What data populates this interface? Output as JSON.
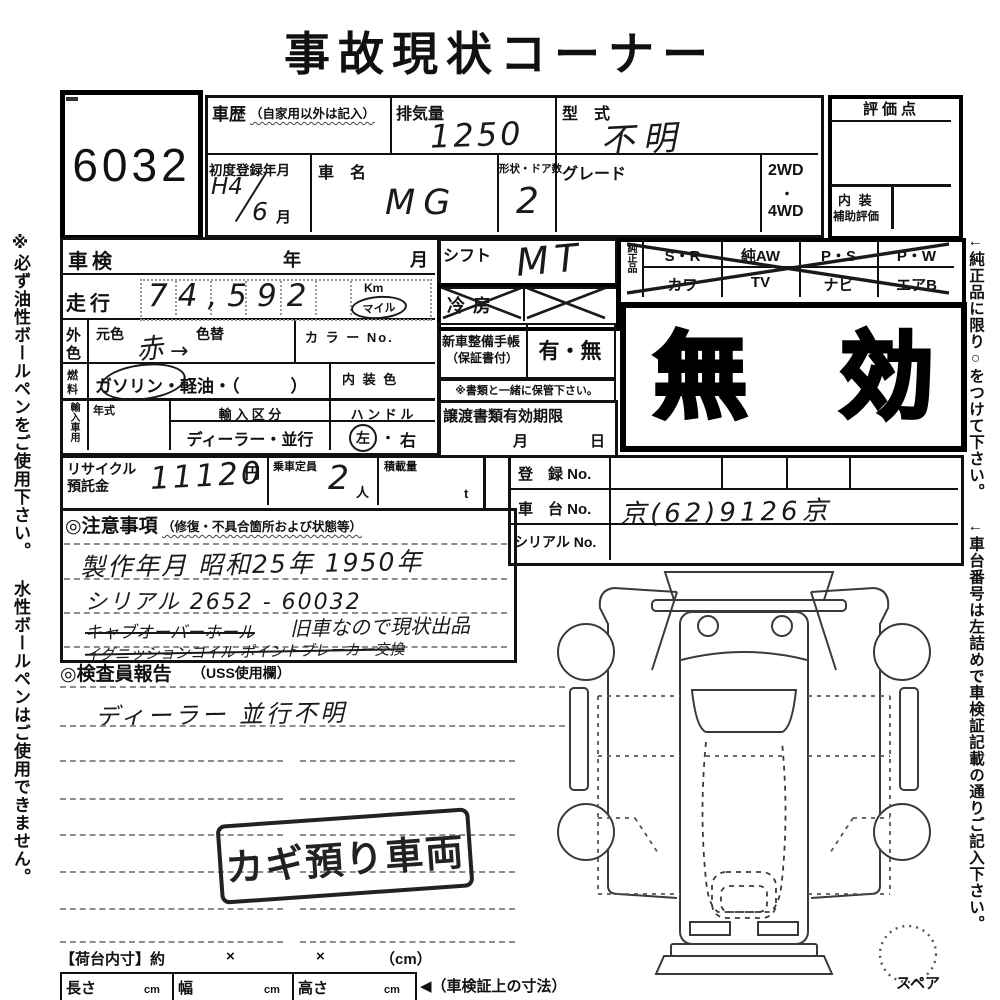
{
  "title": "事故現状コーナー",
  "lot_number": "6032",
  "header": {
    "history_label": "車歴",
    "history_note": "（自家用以外は記入）",
    "displacement_label": "排気量",
    "displacement_value": "1250",
    "model_label": "型　式",
    "model_value": "不明",
    "first_reg_label": "初度登録年月",
    "first_reg_era": "H4",
    "first_reg_month_value": "6",
    "first_reg_month_unit": "月",
    "car_name_label": "車　名",
    "car_name_value": "MG",
    "shape_doors_label": "形状・ドア数",
    "shape_doors_value": "2",
    "grade_label": "グレード",
    "wd2": "2WD",
    "wd_dot": "・",
    "wd4": "4WD",
    "score_label": "評価点",
    "interior_label": "内 装",
    "interior_sub_label": "補助評価"
  },
  "inspection": {
    "shaken_label": "車検",
    "year": "年",
    "month": "月",
    "mileage_label": "走行",
    "mileage_value": "74,592",
    "km": "Km",
    "mile": "マイル",
    "ext_color_1": "外",
    "ext_color_2": "色",
    "orig_color_label": "元色",
    "recolor_label": "色替",
    "color_value": "赤",
    "color_arrow": "→",
    "color_no_label": "カ ラ ー No.",
    "fuel_1": "燃",
    "fuel_2": "料",
    "fuel_pre": "ガ",
    "fuel_circled": "ソリン",
    "fuel_post": "・軽油・（　　　）",
    "int_color_label": "内 装 色",
    "import_label": "輸入車用",
    "year_model_label": "年式",
    "import_class_label": "輸 入 区 分",
    "import_class_value": "ディーラー・並行",
    "handle_label": "ハ ン ド ル",
    "handle_left": "左",
    "handle_dot": "・",
    "handle_right": "右"
  },
  "recycle": {
    "label_1": "リサイクル",
    "label_2": "預託金",
    "value": "11120",
    "yen": "円",
    "capacity_label": "乗車定員",
    "capacity_value": "2",
    "nin": "人",
    "load_label": "積載量",
    "ton": "t"
  },
  "shift": {
    "label": "シフト",
    "value": "MT",
    "ac_label": "冷房",
    "booklet_label_1": "新車整備手帳",
    "booklet_label_2": "（保証書付）",
    "booklet_value": "有・無",
    "keep_note": "※書類と一緒に保管下さい。",
    "transfer_label": "譲渡書類有効期限",
    "transfer_month": "月",
    "transfer_day": "日"
  },
  "genuine": {
    "label": "純正品",
    "row1": [
      "S・R",
      "純AW",
      "P・S",
      "P・W"
    ],
    "row2": [
      "カワ",
      "TV",
      "ナビ",
      "エアB"
    ]
  },
  "invalid_stamp": {
    "char1": "無",
    "char2": "効"
  },
  "registration": {
    "reg_no_label": "登　録 No.",
    "chassis_no_label": "車　台 No.",
    "chassis_no_value": "京(62)9126京",
    "serial_no_label": "シリアル No."
  },
  "notes": {
    "heading": "◎注意事項",
    "heading_note": "（修復・不具合箇所および状態等）",
    "line1": "製作年月 昭和25年 1950年",
    "line2": "シリアル 2652 - 60032",
    "line3_struck": "キャブオーバーホール",
    "line3_rest": "旧車なので現状出品",
    "line4_struck": "イグニッションコイル ポイントブレーカー交換"
  },
  "inspector": {
    "heading": "◎検査員報告",
    "heading_note": "（USS使用欄）",
    "value": "ディーラー 並行不明"
  },
  "key_stamp": "カギ預り車両",
  "diagram": {
    "spare_label": "スペア"
  },
  "cargo": {
    "label": "【荷台内寸】約",
    "x1": "×",
    "x2": "×",
    "cm_note": "（cm）",
    "length_label": "長さ",
    "cm1": "cm",
    "width_label": "幅",
    "cm2": "cm",
    "height_label": "高さ",
    "cm3": "cm",
    "arrow_note": "◀（車検証上の寸法）"
  },
  "sidebar": {
    "left": "※必ず油性ボールペンをご使用下さい。 水性ボールペンはご使用できません。",
    "right": "←純正品に限り○をつけて下さい。 ←車台番号は左詰めで車検証記載の通りご記入下さい。"
  },
  "colors": {
    "ink": "#111111",
    "paper": "#ffffff"
  }
}
